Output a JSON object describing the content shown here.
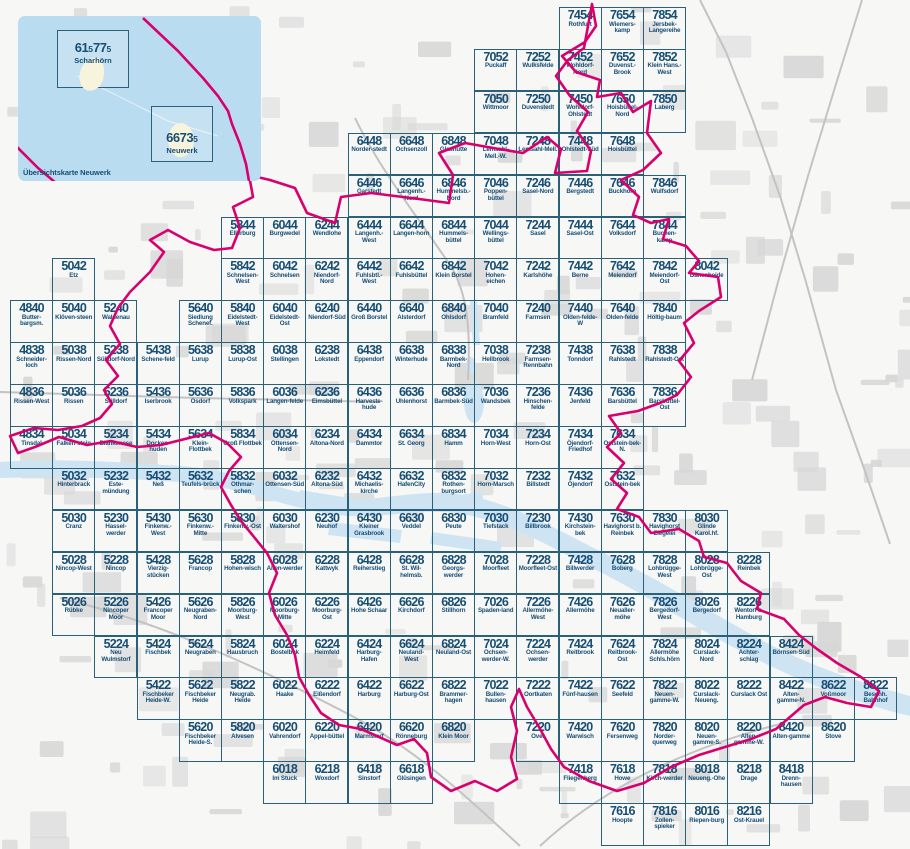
{
  "colors": {
    "tile_border": "#2a6078",
    "tile_text": "#174e74",
    "boundary": "#d8006e",
    "water": "#cfe4f2",
    "inset_bg": "#badcf0",
    "island": "#f8f3dc",
    "land_patch": "#d7d7d7",
    "road": "#c3c3c3"
  },
  "inset": {
    "caption": "Übersichtskarte Neuwerk",
    "sheets": [
      {
        "number_big1": "61",
        "number_small1": "5",
        "number_big2": "77",
        "number_small2": "5",
        "name": "Scharhörn"
      },
      {
        "number_big1": "6673",
        "number_small1": "5",
        "number_big2": "",
        "number_small2": "",
        "name": "Neuwerk"
      }
    ]
  },
  "grid": {
    "origin_x": 10,
    "origin_y": 7,
    "cell_w": 42.2,
    "cell_h": 41.9,
    "col_base": 48,
    "row_base": 54
  },
  "tiles": [
    [
      "7454",
      "Rothfurt"
    ],
    [
      "7654",
      "Wiemers-kamp"
    ],
    [
      "7854",
      "Jersbek-Langereihe"
    ],
    [
      "7052",
      "Puckaff"
    ],
    [
      "7252",
      "Wulksfelde"
    ],
    [
      "7452",
      "Wohldorf-Nord"
    ],
    [
      "7652",
      "Duvenst.-Brook"
    ],
    [
      "7852",
      "Klein Hans.-West"
    ],
    [
      "7050",
      "Wittmoor"
    ],
    [
      "7250",
      "Duvenstedt"
    ],
    [
      "7450",
      "Wohldorf-Ohlstedt"
    ],
    [
      "7650",
      "Hoisbüttel-Nord"
    ],
    [
      "7850",
      "Laberg"
    ],
    [
      "6448",
      "Norder-stedt"
    ],
    [
      "6648",
      "Ochsenzoll"
    ],
    [
      "6848",
      "Glashütte"
    ],
    [
      "7048",
      "Lemsahl-Mell.-W."
    ],
    [
      "7248",
      "Lemsahl-Mell."
    ],
    [
      "7448",
      "Ohlstedt-Süd"
    ],
    [
      "7648",
      "Hoisbüttel"
    ],
    [
      "6446",
      "Garstedt"
    ],
    [
      "6646",
      "Langenh.-Nord"
    ],
    [
      "6846",
      "Hummelsb.-Nord"
    ],
    [
      "7046",
      "Poppen-büttel"
    ],
    [
      "7246",
      "Sasel-Nord"
    ],
    [
      "7446",
      "Bergstedt"
    ],
    [
      "7646",
      "Buckhorn"
    ],
    [
      "7846",
      "Wulfsdorf"
    ],
    [
      "5844",
      "Ellerburg"
    ],
    [
      "6044",
      "Burgwedel"
    ],
    [
      "6244",
      "Wendlohe"
    ],
    [
      "6444",
      "Langenh.-West"
    ],
    [
      "6644",
      "Langen-horn"
    ],
    [
      "6844",
      "Hummels-büttel"
    ],
    [
      "7044",
      "Wellings-büttel"
    ],
    [
      "7244",
      "Sasel"
    ],
    [
      "7444",
      "Sasel-Ost"
    ],
    [
      "7644",
      "Volksdorf"
    ],
    [
      "7844",
      "Buchen-kamp"
    ],
    [
      "5042",
      "Etz"
    ],
    [
      "5842",
      "Schnelsen-West"
    ],
    [
      "6042",
      "Schnelsen"
    ],
    [
      "6242",
      "Niendorf-Nord"
    ],
    [
      "6442",
      "Fuhlsbtl.-West"
    ],
    [
      "6642",
      "Fuhlsbüttel"
    ],
    [
      "6842",
      "Klein Borstel"
    ],
    [
      "7042",
      "Hohen-eichen"
    ],
    [
      "7242",
      "Karlshöhe"
    ],
    [
      "7442",
      "Berne"
    ],
    [
      "7642",
      "Meiendorf"
    ],
    [
      "7842",
      "Meiendorf-Ost"
    ],
    [
      "8042",
      "Dänenheide"
    ],
    [
      "4840",
      "Butter-bargsm."
    ],
    [
      "5040",
      "Klöven-steen"
    ],
    [
      "5240",
      "Waldenau"
    ],
    [
      "5640",
      "Siedlung Schenef."
    ],
    [
      "5840",
      "Eidelstedt-West"
    ],
    [
      "6040",
      "Eidelstedt-Ost"
    ],
    [
      "6240",
      "Niendorf-Süd"
    ],
    [
      "6440",
      "Groß Borstel"
    ],
    [
      "6640",
      "Alsterdorf"
    ],
    [
      "6840",
      "Ohlsdorf"
    ],
    [
      "7040",
      "Bramfeld"
    ],
    [
      "7240",
      "Farmsen"
    ],
    [
      "7440",
      "Olden-felde-W"
    ],
    [
      "7640",
      "Olden-felde"
    ],
    [
      "7840",
      "Höltig-baum"
    ],
    [
      "4838",
      "Schneider-loch"
    ],
    [
      "5038",
      "Rissen-Nord"
    ],
    [
      "5238",
      "Sülldorf-Nord"
    ],
    [
      "5438",
      "Schene-feld"
    ],
    [
      "5638",
      "Lurup"
    ],
    [
      "5838",
      "Lurup-Ost"
    ],
    [
      "6038",
      "Stellingen"
    ],
    [
      "6238",
      "Lokstedt"
    ],
    [
      "6438",
      "Eppendorf"
    ],
    [
      "6638",
      "Winterhude"
    ],
    [
      "6838",
      "Barmbek-Nord"
    ],
    [
      "7038",
      "Hellbrook"
    ],
    [
      "7238",
      "Farmsen-Rennbahn"
    ],
    [
      "7438",
      "Tonndorf"
    ],
    [
      "7638",
      "Rahlstedt"
    ],
    [
      "7838",
      "Rahlstedt-Ost"
    ],
    [
      "4836",
      "Rissen-West"
    ],
    [
      "5036",
      "Rissen"
    ],
    [
      "5236",
      "Sülldorf"
    ],
    [
      "5436",
      "Iserbrook"
    ],
    [
      "5636",
      "Osdorf"
    ],
    [
      "5836",
      "Volkspark"
    ],
    [
      "6036",
      "Langen-felde"
    ],
    [
      "6236",
      "Eimsbüttel"
    ],
    [
      "6436",
      "Harveste-hude"
    ],
    [
      "6636",
      "Uhlenhorst"
    ],
    [
      "6836",
      "Barmbek-Süd"
    ],
    [
      "7036",
      "Wandsbek"
    ],
    [
      "7236",
      "Hinschen-felde"
    ],
    [
      "7436",
      "Jenfeld"
    ],
    [
      "7636",
      "Barsbüttel"
    ],
    [
      "7836",
      "Barsbüttel-Ost"
    ],
    [
      "4834",
      "Tinsdal"
    ],
    [
      "5034",
      "Falken-stein"
    ],
    [
      "5234",
      "Blankenese"
    ],
    [
      "5434",
      "Docken-huden"
    ],
    [
      "5634",
      "Klein-Flottbek"
    ],
    [
      "5834",
      "Groß Flottbek"
    ],
    [
      "6034",
      "Ottensen-Nord"
    ],
    [
      "6234",
      "Altona-Nord"
    ],
    [
      "6434",
      "Dammtor"
    ],
    [
      "6634",
      "St. Georg"
    ],
    [
      "6834",
      "Hamm"
    ],
    [
      "7034",
      "Horn-West"
    ],
    [
      "7234",
      "Horn-Ost"
    ],
    [
      "7434",
      "Öjendorf-Friedhof"
    ],
    [
      "7634",
      "Oststein-bek-N."
    ],
    [
      "5032",
      "Hinterbrack"
    ],
    [
      "5232",
      "Este-mündung"
    ],
    [
      "5432",
      "Neß"
    ],
    [
      "5632",
      "Teufels-brück"
    ],
    [
      "5832",
      "Othmar-schen"
    ],
    [
      "6032",
      "Ottensen-Süd"
    ],
    [
      "6232",
      "Altona-Süd"
    ],
    [
      "6432",
      "Michaelis-kirche"
    ],
    [
      "6632",
      "HafenCity"
    ],
    [
      "6832",
      "Rothen-burgsort"
    ],
    [
      "7032",
      "Horn-Marsch"
    ],
    [
      "7232",
      "Billstedt"
    ],
    [
      "7432",
      "Öjendorf"
    ],
    [
      "7632",
      "Oststein-bek"
    ],
    [
      "5030",
      "Cranz"
    ],
    [
      "5230",
      "Hassel-werder"
    ],
    [
      "5430",
      "Finkenw.-West"
    ],
    [
      "5630",
      "Finkenw.-Mitte"
    ],
    [
      "5830",
      "Finkenw.-Ost"
    ],
    [
      "6030",
      "Waltershof"
    ],
    [
      "6230",
      "Neuhof"
    ],
    [
      "6430",
      "Kleiner Grasbrook"
    ],
    [
      "6630",
      "Veddel"
    ],
    [
      "6830",
      "Peute"
    ],
    [
      "7030",
      "Tiefstack"
    ],
    [
      "7230",
      "Billbrook"
    ],
    [
      "7430",
      "Kirchstein-bek"
    ],
    [
      "7630",
      "Havighorst b. Reinbek"
    ],
    [
      "7830",
      "Havighorst Ziegelei"
    ],
    [
      "8030",
      "Glinde Karol.hf."
    ],
    [
      "5028",
      "Nincop-West"
    ],
    [
      "5228",
      "Nincop"
    ],
    [
      "5428",
      "Vierzig-stücken"
    ],
    [
      "5628",
      "Francop"
    ],
    [
      "5828",
      "Hohen-wisch"
    ],
    [
      "6028",
      "Alten-werder"
    ],
    [
      "6228",
      "Kattwyk"
    ],
    [
      "6428",
      "Reiherstieg"
    ],
    [
      "6628",
      "St. Wil-helmsb."
    ],
    [
      "6828",
      "Georgs-werder"
    ],
    [
      "7028",
      "Moorfleet"
    ],
    [
      "7228",
      "Moorfleet-Ost"
    ],
    [
      "7428",
      "Billwerder"
    ],
    [
      "7628",
      "Boberg"
    ],
    [
      "7828",
      "Lohbrügge-West"
    ],
    [
      "8028",
      "Lohbrügge-Ost"
    ],
    [
      "8228",
      "Reinbek"
    ],
    [
      "5026",
      "Rübke"
    ],
    [
      "5226",
      "Nincoper Moor"
    ],
    [
      "5426",
      "Francoper Moor"
    ],
    [
      "5626",
      "Neugraben-Nord"
    ],
    [
      "5826",
      "Moorburg-West"
    ],
    [
      "6026",
      "Moorburg-Mitte"
    ],
    [
      "6226",
      "Moorburg-Ost"
    ],
    [
      "6426",
      "Hohe Schaar"
    ],
    [
      "6626",
      "Kirchdorf"
    ],
    [
      "6826",
      "Stillhorn"
    ],
    [
      "7026",
      "Spaden-land"
    ],
    [
      "7226",
      "Allermöhe-West"
    ],
    [
      "7426",
      "Allermöhe"
    ],
    [
      "7626",
      "Neualler-möhe"
    ],
    [
      "7826",
      "Bergedorf-West"
    ],
    [
      "8026",
      "Bergedorf"
    ],
    [
      "8226",
      "Wentorf b. Hamburg"
    ],
    [
      "5224",
      "Neu Wulmstorf"
    ],
    [
      "5424",
      "Fischbek"
    ],
    [
      "5624",
      "Neugraben"
    ],
    [
      "5824",
      "Hausbruch"
    ],
    [
      "6024",
      "Bostelbek"
    ],
    [
      "6224",
      "Heimfeld"
    ],
    [
      "6424",
      "Harburg-Hafen"
    ],
    [
      "6624",
      "Neuland-West"
    ],
    [
      "6824",
      "Neuland-Ost"
    ],
    [
      "7024",
      "Ochsen-werder-W."
    ],
    [
      "7224",
      "Ochsen-werder"
    ],
    [
      "7424",
      "Reitbrook"
    ],
    [
      "7624",
      "Reitbrook-Ost"
    ],
    [
      "7824",
      "Allermöhe Schls.hörn"
    ],
    [
      "8024",
      "Curslack-Nord"
    ],
    [
      "8224",
      "Achter-schlag"
    ],
    [
      "8424",
      "Börnsen-Süd"
    ],
    [
      "5422",
      "Fischbeker Heide-W."
    ],
    [
      "5622",
      "Fischbeker Heide"
    ],
    [
      "5822",
      "Neugrab. Heide"
    ],
    [
      "6022",
      "Haake"
    ],
    [
      "6222",
      "Eißendorf"
    ],
    [
      "6422",
      "Harburg"
    ],
    [
      "6622",
      "Harburg-Ost"
    ],
    [
      "6822",
      "Brammer-hagen"
    ],
    [
      "7022",
      "Bullen-hausen"
    ],
    [
      "7222",
      "Oortkaten"
    ],
    [
      "7422",
      "Fünf-hausen"
    ],
    [
      "7622",
      "Seefeld"
    ],
    [
      "7822",
      "Neuen-gamme-W."
    ],
    [
      "8022",
      "Curslack-Neueng."
    ],
    [
      "8222",
      "Curslack Ost"
    ],
    [
      "8422",
      "Alten-gamme-N."
    ],
    [
      "8622",
      "Voßmoor"
    ],
    [
      "8822",
      "Besenh. Bahnhof"
    ],
    [
      "5620",
      "Fischbeker Heide-S."
    ],
    [
      "5820",
      "Alvesen"
    ],
    [
      "6020",
      "Vahrendorf"
    ],
    [
      "6220",
      "Appel-büttel"
    ],
    [
      "6420",
      "Marmstorf"
    ],
    [
      "6620",
      "Rönneburg"
    ],
    [
      "6820",
      "Klein Moor"
    ],
    [
      "7220",
      "Over"
    ],
    [
      "7420",
      "Warwisch"
    ],
    [
      "7620",
      "Fersenweg"
    ],
    [
      "7820",
      "Norder-querweg"
    ],
    [
      "8020",
      "Neuen-gamme-S."
    ],
    [
      "8220",
      "Alten-gamme-W."
    ],
    [
      "8420",
      "Alten-gamme"
    ],
    [
      "8620",
      "Stove"
    ],
    [
      "6018",
      "Im Stuck"
    ],
    [
      "6218",
      "Woxdorf"
    ],
    [
      "6418",
      "Sinstorf"
    ],
    [
      "6618",
      "Glüsingen"
    ],
    [
      "7418",
      "Fliegenberg"
    ],
    [
      "7618",
      "Howe"
    ],
    [
      "7818",
      "Kirch-werder"
    ],
    [
      "8018",
      "Neueng.-Ohe"
    ],
    [
      "8218",
      "Drage"
    ],
    [
      "8418",
      "Drenn-hausen"
    ],
    [
      "7616",
      "Hoopte"
    ],
    [
      "7816",
      "Zollen-spieker"
    ],
    [
      "8016",
      "Riepen-burg"
    ],
    [
      "8216",
      "Ost-Krauel"
    ]
  ]
}
